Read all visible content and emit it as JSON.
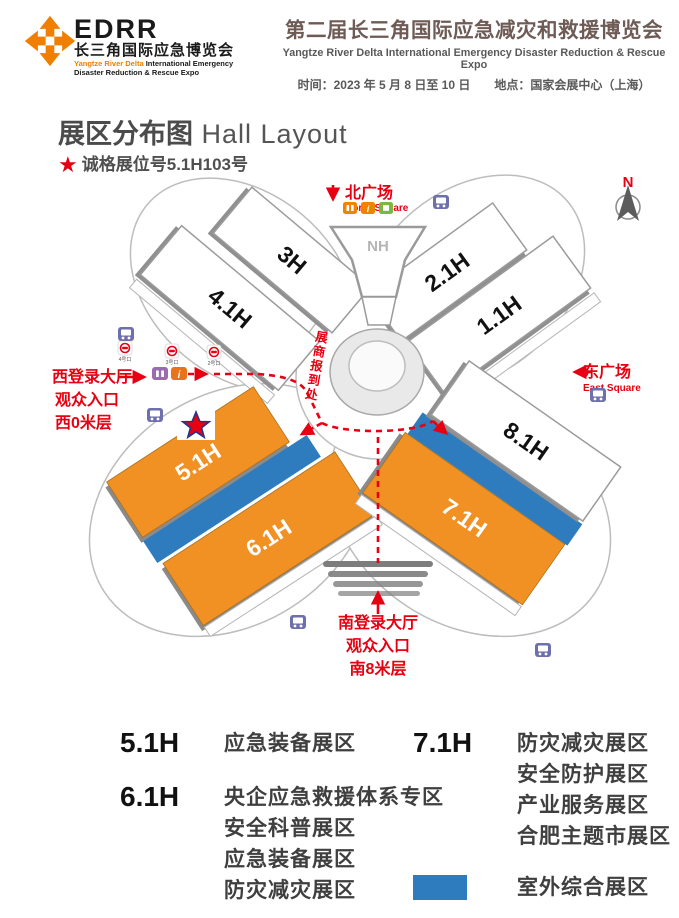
{
  "header": {
    "logo": {
      "acronym": "EDRR",
      "cn_name": "长三角国际应急博览会",
      "en_orange": "Yangtze River Delta",
      "en_rest": " International Emergency",
      "en_line2": "Disaster Reduction & Rescue Expo"
    },
    "expo": {
      "title_cn": "第二届长三角国际应急减灾和救援博览会",
      "title_en": "Yangtze River Delta International Emergency Disaster Reduction & Rescue Expo",
      "schedule": "时间：2023 年 5 月 8 日至 10 日　　地点：国家会展中心（上海）"
    }
  },
  "section": {
    "title_cn": "展区分布图",
    "title_en": " Hall Layout",
    "booth_note": "诚格展位号5.1H103号"
  },
  "map": {
    "compass": "N",
    "north_square": {
      "cn": "北广场",
      "en": "North Square"
    },
    "east_square": {
      "cn": "东广场",
      "en": "East Square"
    },
    "west_entrance": {
      "line1": "西登录大厅",
      "line2": "观众入口",
      "line3": "西0米层"
    },
    "south_entrance": {
      "line1": "南登录大厅",
      "line2": "观众入口",
      "line3": "南8米层"
    },
    "registration": "展商报到处",
    "halls": {
      "h3": "3H",
      "h41": "4.1H",
      "h21": "2.1H",
      "h11": "1.1H",
      "nh": "NH",
      "h51": "5.1H",
      "h61": "6.1H",
      "h71": "7.1H",
      "h81": "8.1H"
    },
    "metro_exits": [
      "4号口",
      "3号口",
      "2号口"
    ],
    "colors": {
      "hall_orange": "#F19123",
      "outdoor_blue": "#2E7CBD",
      "route_red": "#E60012"
    }
  },
  "legend": {
    "items": [
      {
        "code": "5.1H",
        "lines": [
          "应急装备展区"
        ]
      },
      {
        "code": "6.1H",
        "lines": [
          "央企应急救援体系专区",
          "安全科普展区",
          "应急装备展区",
          "防灾减灾展区"
        ]
      },
      {
        "code": "7.1H",
        "lines": [
          "防灾减灾展区",
          "安全防护展区",
          "产业服务展区",
          "合肥主题市展区"
        ]
      }
    ],
    "outdoor": {
      "label": "室外综合展区"
    }
  }
}
